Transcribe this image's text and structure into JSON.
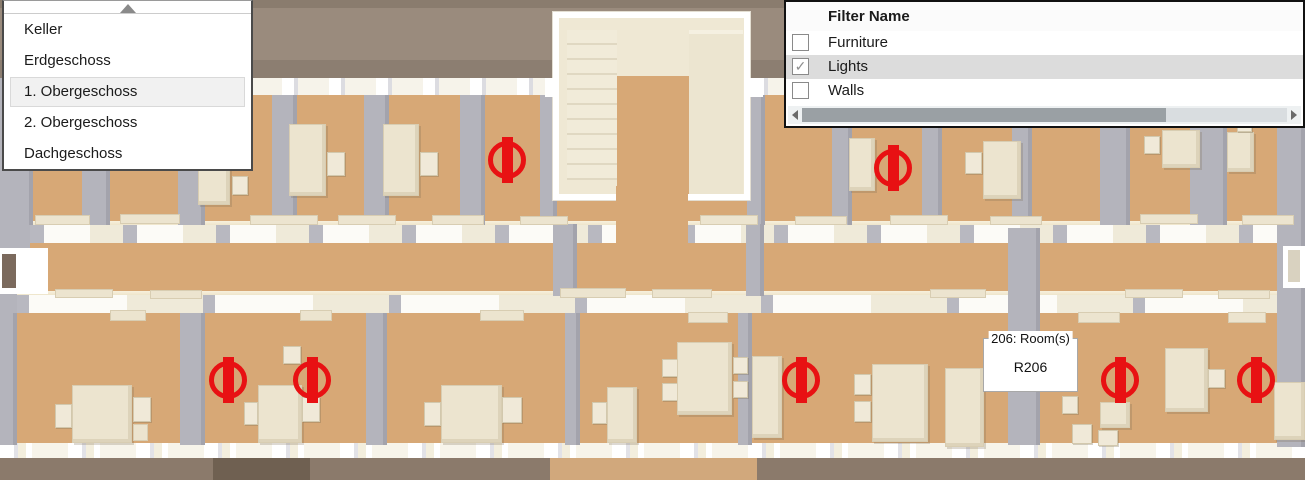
{
  "floor_selector": {
    "scroll_up_icon": "up-triangle",
    "items": [
      {
        "label": "Keller",
        "selected": false
      },
      {
        "label": "Erdgeschoss",
        "selected": false
      },
      {
        "label": "1. Obergeschoss",
        "selected": true
      },
      {
        "label": "2. Obergeschoss",
        "selected": false
      },
      {
        "label": "Dachgeschoss",
        "selected": false
      }
    ]
  },
  "filter_panel": {
    "title": "Filter Name",
    "items": [
      {
        "label": "Furniture",
        "checked": false,
        "highlighted": false
      },
      {
        "label": "Lights",
        "checked": true,
        "highlighted": true
      },
      {
        "label": "Walls",
        "checked": false,
        "highlighted": false
      }
    ],
    "checkmark_glyph": "✓",
    "scrollbar": {
      "orientation": "horizontal",
      "thumb_left_pct": 0,
      "thumb_width_pct": 75
    }
  },
  "tooltip": {
    "title": "206: Room(s)",
    "value": "R206"
  },
  "colors": {
    "floor_tan": "#d7a876",
    "wall_gray": "#b4b4bc",
    "furniture_cream": "#ece4cf",
    "exterior_brown_top": "#9a8b7d",
    "exterior_brown_bottom": "#8b7a6b",
    "light_red": "#e81113",
    "selection_gray": "#dcdcdc"
  },
  "scene": {
    "lights": [
      {
        "x": 507,
        "y": 160
      },
      {
        "x": 893,
        "y": 168
      },
      {
        "x": 228,
        "y": 380
      },
      {
        "x": 312,
        "y": 380
      },
      {
        "x": 801,
        "y": 380
      },
      {
        "x": 1120,
        "y": 380
      },
      {
        "x": 1256,
        "y": 380
      }
    ],
    "pillars": [
      [
        0,
        95,
        33,
        130
      ],
      [
        82,
        95,
        28,
        130
      ],
      [
        178,
        95,
        27,
        130
      ],
      [
        272,
        95,
        25,
        130
      ],
      [
        364,
        95,
        25,
        130
      ],
      [
        460,
        95,
        25,
        130
      ],
      [
        540,
        95,
        17,
        130
      ],
      [
        747,
        95,
        18,
        130
      ],
      [
        832,
        95,
        20,
        130
      ],
      [
        922,
        95,
        20,
        130
      ],
      [
        1012,
        95,
        20,
        130
      ],
      [
        1100,
        95,
        30,
        130
      ],
      [
        1190,
        95,
        37,
        130
      ],
      [
        553,
        224,
        24,
        72
      ],
      [
        746,
        224,
        18,
        72
      ],
      [
        0,
        313,
        17,
        132
      ],
      [
        180,
        313,
        25,
        132
      ],
      [
        366,
        313,
        21,
        132
      ],
      [
        565,
        313,
        15,
        132
      ],
      [
        738,
        313,
        14,
        132
      ],
      [
        1008,
        228,
        32,
        217
      ],
      [
        1277,
        95,
        28,
        352
      ]
    ],
    "furniture": [
      [
        "desk",
        289,
        124,
        37,
        72
      ],
      [
        "chair",
        327,
        152,
        18,
        24
      ],
      [
        "desk",
        383,
        124,
        36,
        72
      ],
      [
        "chair",
        420,
        152,
        18,
        24
      ],
      [
        "desk",
        198,
        158,
        32,
        47
      ],
      [
        "chair",
        232,
        176,
        16,
        19
      ],
      [
        "desk",
        849,
        138,
        26,
        53
      ],
      [
        "desk",
        983,
        141,
        38,
        58
      ],
      [
        "chair",
        965,
        152,
        17,
        22
      ],
      [
        "desk",
        1162,
        130,
        38,
        38
      ],
      [
        "chair",
        1144,
        136,
        16,
        18
      ],
      [
        "desk",
        1227,
        132,
        27,
        40
      ],
      [
        "chair",
        1237,
        118,
        15,
        14
      ],
      [
        "side",
        35,
        215,
        55,
        10
      ],
      [
        "side",
        120,
        214,
        60,
        10
      ],
      [
        "side",
        250,
        215,
        68,
        10
      ],
      [
        "side",
        338,
        215,
        58,
        10
      ],
      [
        "side",
        432,
        215,
        52,
        10
      ],
      [
        "side",
        520,
        216,
        48,
        9
      ],
      [
        "side",
        700,
        215,
        58,
        10
      ],
      [
        "side",
        795,
        216,
        52,
        9
      ],
      [
        "side",
        890,
        215,
        58,
        10
      ],
      [
        "side",
        990,
        216,
        52,
        9
      ],
      [
        "side",
        1140,
        214,
        58,
        10
      ],
      [
        "side",
        1242,
        215,
        52,
        10
      ],
      [
        "side",
        55,
        289,
        58,
        9
      ],
      [
        "side",
        150,
        290,
        52,
        9
      ],
      [
        "side",
        560,
        288,
        66,
        10
      ],
      [
        "side",
        652,
        289,
        60,
        9
      ],
      [
        "side",
        930,
        289,
        56,
        9
      ],
      [
        "side",
        1125,
        289,
        58,
        9
      ],
      [
        "side",
        1218,
        290,
        52,
        9
      ],
      [
        "side",
        110,
        310,
        36,
        11
      ],
      [
        "side",
        300,
        310,
        32,
        11
      ],
      [
        "side",
        480,
        310,
        44,
        11
      ],
      [
        "side",
        688,
        312,
        40,
        11
      ],
      [
        "side",
        1078,
        312,
        42,
        11
      ],
      [
        "side",
        1228,
        312,
        38,
        11
      ],
      [
        "side",
        607,
        430,
        30,
        13
      ],
      [
        "chair",
        55,
        404,
        17,
        24
      ],
      [
        "desk",
        72,
        385,
        60,
        58
      ],
      [
        "chair",
        133,
        397,
        18,
        25
      ],
      [
        "side",
        133,
        424,
        15,
        17
      ],
      [
        "chair",
        244,
        402,
        14,
        23
      ],
      [
        "desk",
        258,
        385,
        44,
        58
      ],
      [
        "chair",
        302,
        397,
        18,
        25
      ],
      [
        "chair",
        283,
        346,
        18,
        18
      ],
      [
        "chair",
        424,
        402,
        17,
        24
      ],
      [
        "desk",
        441,
        385,
        61,
        58
      ],
      [
        "chair",
        502,
        397,
        20,
        26
      ],
      [
        "chair",
        592,
        402,
        15,
        22
      ],
      [
        "desk",
        607,
        387,
        30,
        56
      ],
      [
        "chair",
        662,
        359,
        16,
        18
      ],
      [
        "chair",
        662,
        383,
        16,
        18
      ],
      [
        "table",
        677,
        342,
        55,
        73
      ],
      [
        "chair",
        733,
        357,
        15,
        17
      ],
      [
        "chair",
        733,
        381,
        15,
        17
      ],
      [
        "desk",
        752,
        356,
        30,
        82
      ],
      [
        "chair",
        854,
        374,
        17,
        21
      ],
      [
        "chair",
        854,
        401,
        17,
        21
      ],
      [
        "table",
        872,
        364,
        56,
        78
      ],
      [
        "desk",
        945,
        368,
        39,
        79
      ],
      [
        "chair",
        1062,
        396,
        16,
        18
      ],
      [
        "chair",
        1072,
        424,
        20,
        20
      ],
      [
        "chair",
        1098,
        430,
        20,
        16
      ],
      [
        "desk",
        1100,
        402,
        30,
        26
      ],
      [
        "desk",
        1165,
        348,
        43,
        64
      ],
      [
        "chair",
        1208,
        369,
        17,
        19
      ],
      [
        "desk",
        1274,
        382,
        31,
        58
      ]
    ]
  }
}
